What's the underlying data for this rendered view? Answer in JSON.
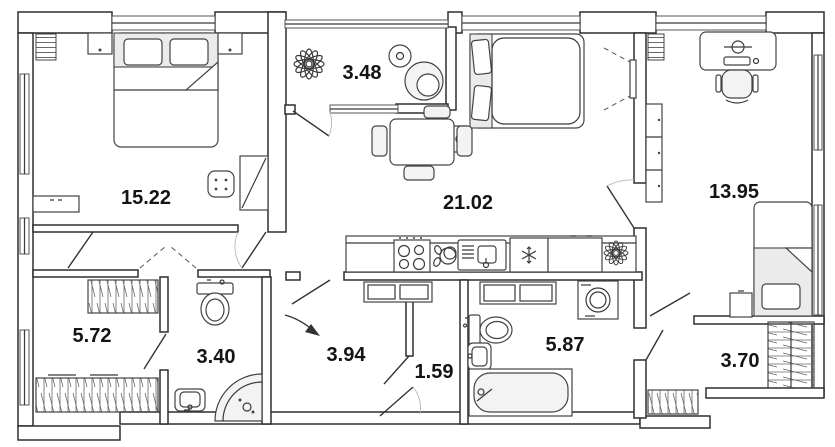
{
  "plan": {
    "title": "apartment-floor-plan",
    "area_unit": "m2",
    "rooms": [
      {
        "name": "bedroom",
        "area": "15.22"
      },
      {
        "name": "balcony",
        "area": "3.48"
      },
      {
        "name": "kitchen-living-room",
        "area": "21.02"
      },
      {
        "name": "bedroom-2",
        "area": "13.95"
      },
      {
        "name": "walk-in-wardrobe",
        "area": "5.72"
      },
      {
        "name": "shower-room",
        "area": "3.40"
      },
      {
        "name": "hallway",
        "area": "3.94"
      },
      {
        "name": "corridor",
        "area": "1.59"
      },
      {
        "name": "bathroom",
        "area": "5.87"
      },
      {
        "name": "closet",
        "area": "3.70"
      }
    ],
    "furniture_icons": [
      "double-bed-icon",
      "pillow-icon",
      "nightstand-icon",
      "radiator-icon",
      "dresser-icon",
      "pouf-icon",
      "wardrobe-icon",
      "plant-icon",
      "round-table-icon",
      "armchair-icon",
      "sofa-bed-icon",
      "side-table-icon",
      "dining-table-icon",
      "chair-icon",
      "tv-icon",
      "kitchen-counter-icon",
      "stove-icon",
      "dish-rack-icon",
      "sink-icon",
      "fridge-snowflake-icon",
      "cabinet-icon",
      "desk-icon",
      "monitor-icon",
      "office-chair-icon",
      "single-bed-icon",
      "clothes-rail-icon",
      "shoe-rack-icon",
      "toilet-icon",
      "wash-basin-icon",
      "corner-shower-icon",
      "bathtub-icon",
      "washing-machine-icon",
      "entry-arrow-icon"
    ],
    "colors": {
      "wall_stroke": "#2e2e2e",
      "furniture_stroke": "#444444",
      "furniture_fill": "#f3f3f3",
      "shade_fill": "#ebebeb",
      "label_color": "#141414",
      "background": "#ffffff"
    }
  }
}
